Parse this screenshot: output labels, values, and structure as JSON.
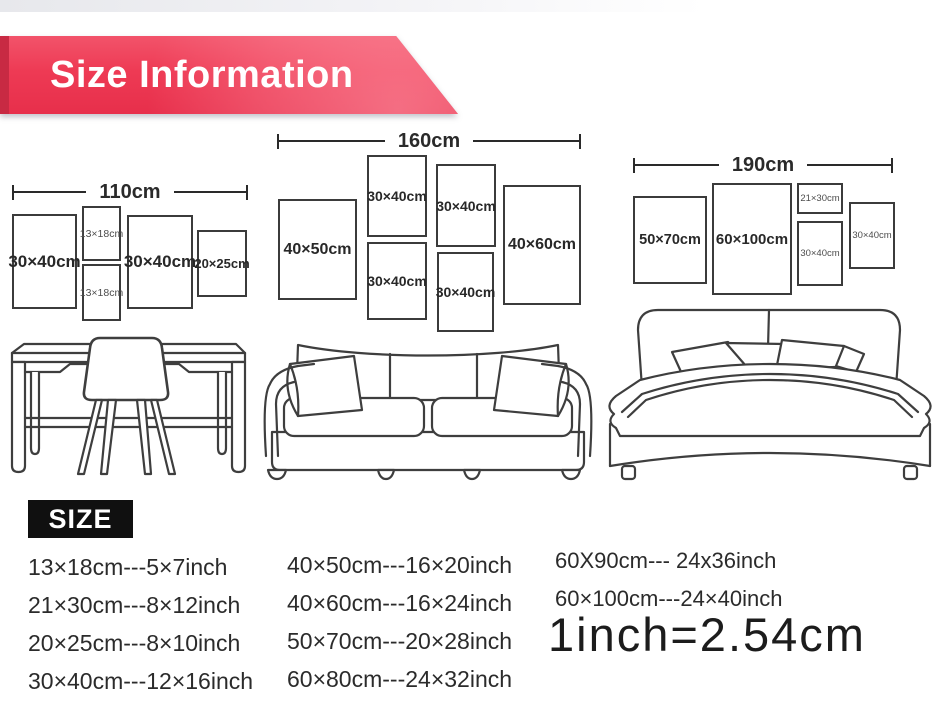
{
  "banner": {
    "title": "Size Information",
    "bg_color": "#ee3a54",
    "fold_color": "#c82a43",
    "text_color": "#ffffff"
  },
  "groups": [
    {
      "id": "desk-wall-set",
      "width_label": "110cm",
      "frames": [
        {
          "label": "30×40cm"
        },
        {
          "label": "13×18cm"
        },
        {
          "label": "13×18cm"
        },
        {
          "label": "30×40cm"
        },
        {
          "label": "20×25cm"
        }
      ]
    },
    {
      "id": "sofa-wall-set",
      "width_label": "160cm",
      "frames": [
        {
          "label": "40×50cm"
        },
        {
          "label": "30×40cm"
        },
        {
          "label": "30×40cm"
        },
        {
          "label": "30×40cm"
        },
        {
          "label": "30×40cm"
        },
        {
          "label": "40×60cm"
        }
      ]
    },
    {
      "id": "bed-wall-set",
      "width_label": "190cm",
      "frames": [
        {
          "label": "50×70cm"
        },
        {
          "label": "60×100cm"
        },
        {
          "label": "21×30cm"
        },
        {
          "label": "30×40cm"
        },
        {
          "label": "30×40cm"
        }
      ]
    }
  ],
  "size_table": {
    "heading": "SIZE",
    "column1": [
      "13×18cm---5×7inch",
      "21×30cm---8×12inch",
      "20×25cm---8×10inch",
      "30×40cm---12×16inch"
    ],
    "column2": [
      "40×50cm---16×20inch",
      "40×60cm---16×24inch",
      "50×70cm---20×28inch",
      "60×80cm---24×32inch"
    ],
    "column3": [
      "60X90cm--- 24x36inch",
      "60×100cm---24×40inch"
    ],
    "conversion_note": "1inch=2.54cm"
  }
}
